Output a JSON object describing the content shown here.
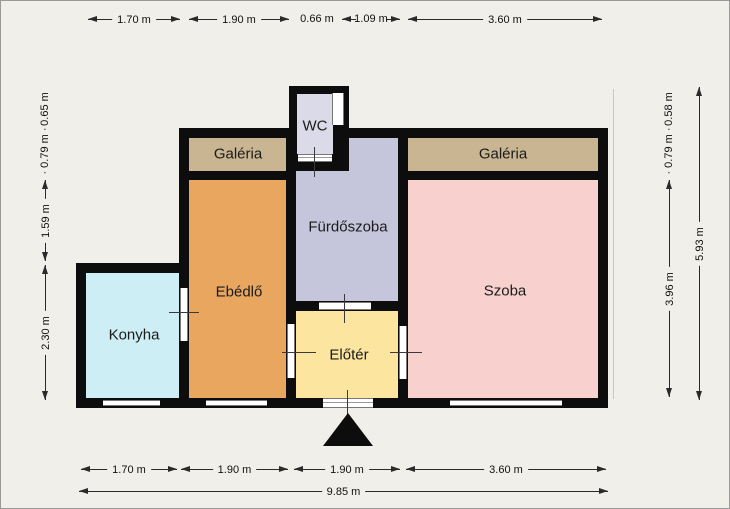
{
  "title": "Apartment floor plan",
  "rooms": [
    {
      "name": "konyha",
      "label": "Konyha",
      "color": "#cdeef5"
    },
    {
      "name": "ebedlo",
      "label": "Ebédlő",
      "color": "#e8a65f"
    },
    {
      "name": "galeria-left",
      "label": "Galéria",
      "color": "#c9b592"
    },
    {
      "name": "wc",
      "label": "WC",
      "color": "#dadae8"
    },
    {
      "name": "furdoszoba",
      "label": "Fürdőszoba",
      "color": "#c5c5dc"
    },
    {
      "name": "galeria-right",
      "label": "Galéria",
      "color": "#c9b592"
    },
    {
      "name": "szoba",
      "label": "Szoba",
      "color": "#f8d1cf"
    },
    {
      "name": "eloter",
      "label": "Előtér",
      "color": "#fbe59f"
    }
  ],
  "dimensions": {
    "top": [
      "1.70 m",
      "1.90 m",
      "0.66 m",
      "1.09 m",
      "3.60 m"
    ],
    "bottom": [
      "1.70 m",
      "1.90 m",
      "1.90 m",
      "3.60 m"
    ],
    "bottom_total": "9.85 m",
    "left": [
      "0.65 m",
      "· 0.79 m ·",
      "1.59 m",
      "2.30 m"
    ],
    "right": [
      "0.58 m",
      "· 0.79 m ·",
      "3.96 m"
    ],
    "right_total": "5.93 m"
  },
  "colors": {
    "background": "#f0efea",
    "walls": "#0d0d0d",
    "dimension_text": "#111111",
    "entrance_marker": "#0d0d0d"
  },
  "entrance": {
    "marker": "triangle-up"
  }
}
